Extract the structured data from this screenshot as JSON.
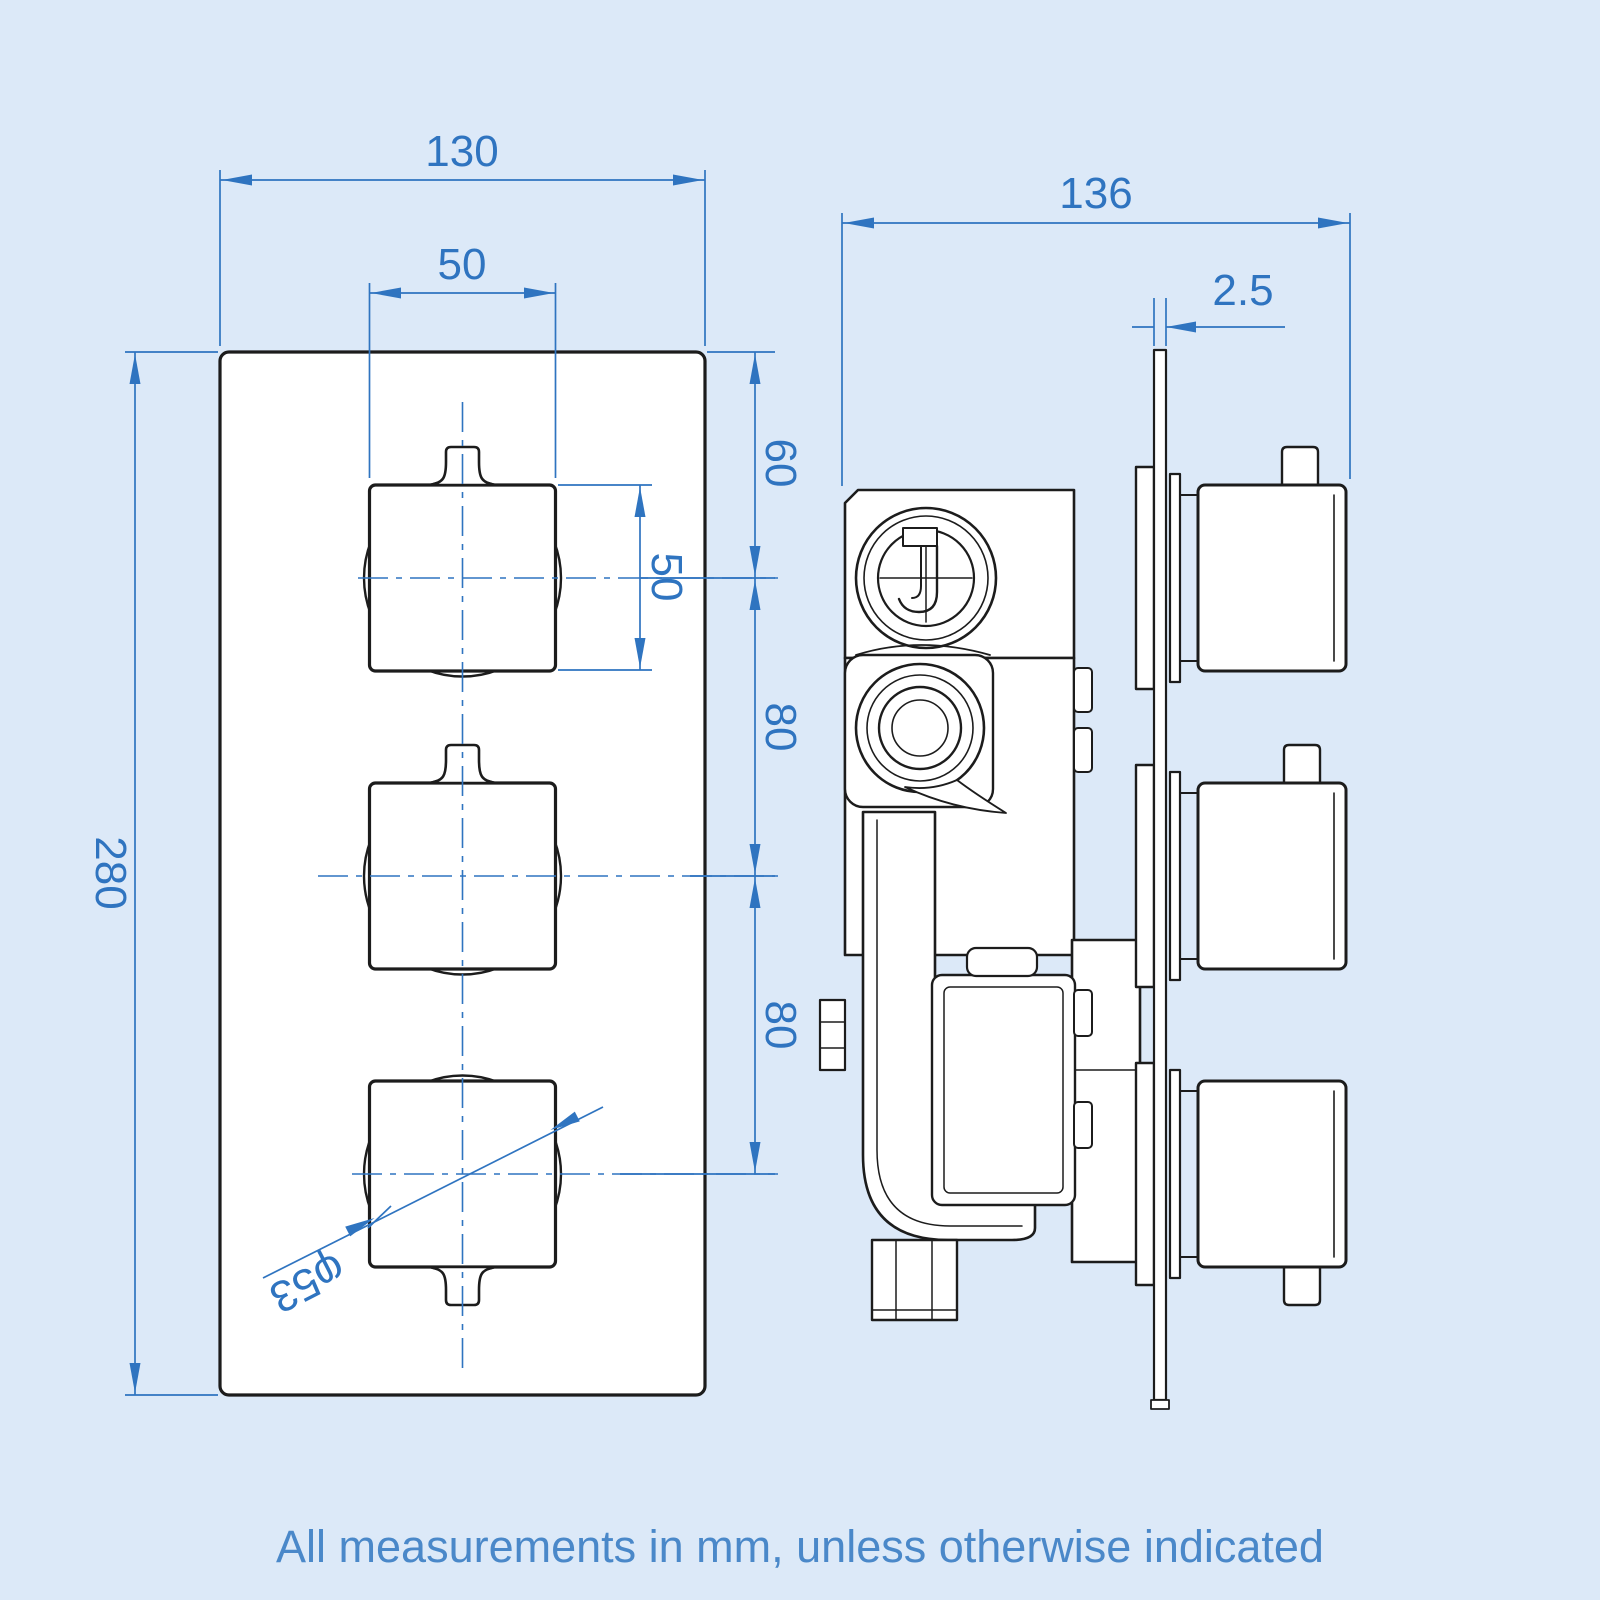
{
  "note": "All measurements in mm, unless otherwise indicated",
  "colors": {
    "background": "#dce9f8",
    "line": "#1c1c1c",
    "dimension": "#2f74c0",
    "note_text": "#4a88c9",
    "surface": "#ffffff"
  },
  "front_view": {
    "dimensions": {
      "overall_width": "130",
      "knob_width": "50",
      "overall_height": "280",
      "top_to_first_knob": "60",
      "knob_height": "50",
      "knob_spacing_upper": "80",
      "knob_spacing_lower": "80",
      "knob_diameter": "φ53"
    }
  },
  "side_view": {
    "dimensions": {
      "overall_depth": "136",
      "plate_thickness": "2.5"
    }
  }
}
